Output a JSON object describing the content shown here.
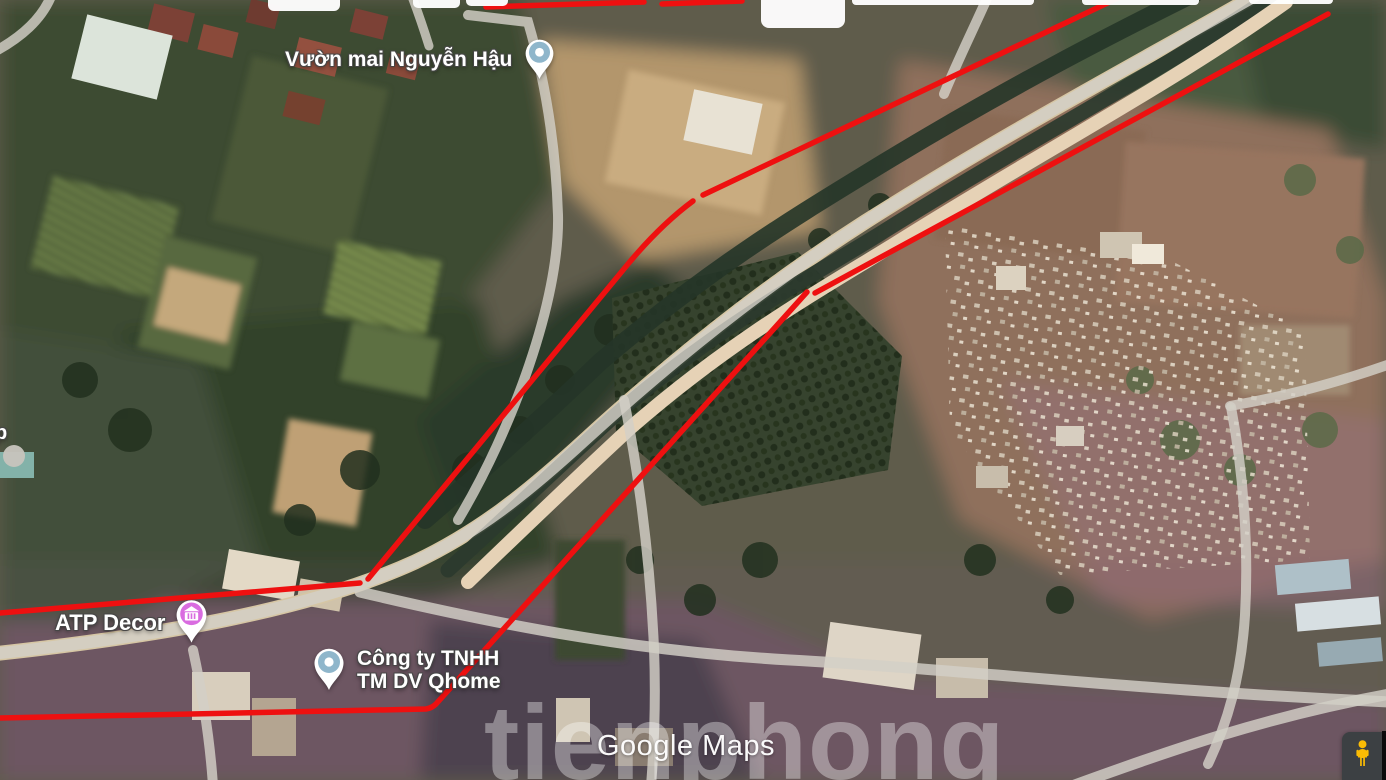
{
  "pois": {
    "nguyen_hau": {
      "label": "Vườn mai Nguyễn Hậu",
      "pin_style": "blue-dot"
    },
    "atp_decor": {
      "label": "ATP Decor",
      "pin_style": "magenta-store"
    },
    "qhome": {
      "line1": "Công ty TNHH",
      "line2": "TM DV Qhome",
      "pin_style": "blue-dot"
    },
    "clipped_left": {
      "label": "p"
    }
  },
  "watermarks": {
    "brand": "Google Maps",
    "news": "tienphong"
  },
  "controls": {
    "pegman": "street-view-pegman"
  },
  "colors": {
    "annotation_red": "#ee1010",
    "pin_blue": "#8fb6cb",
    "pin_magenta": "#d96ce0",
    "pegman_yellow": "#fbbc04",
    "control_bg": "#3c4043",
    "label_white": "#ffffff",
    "road_overlay": "#d3cfc7"
  }
}
